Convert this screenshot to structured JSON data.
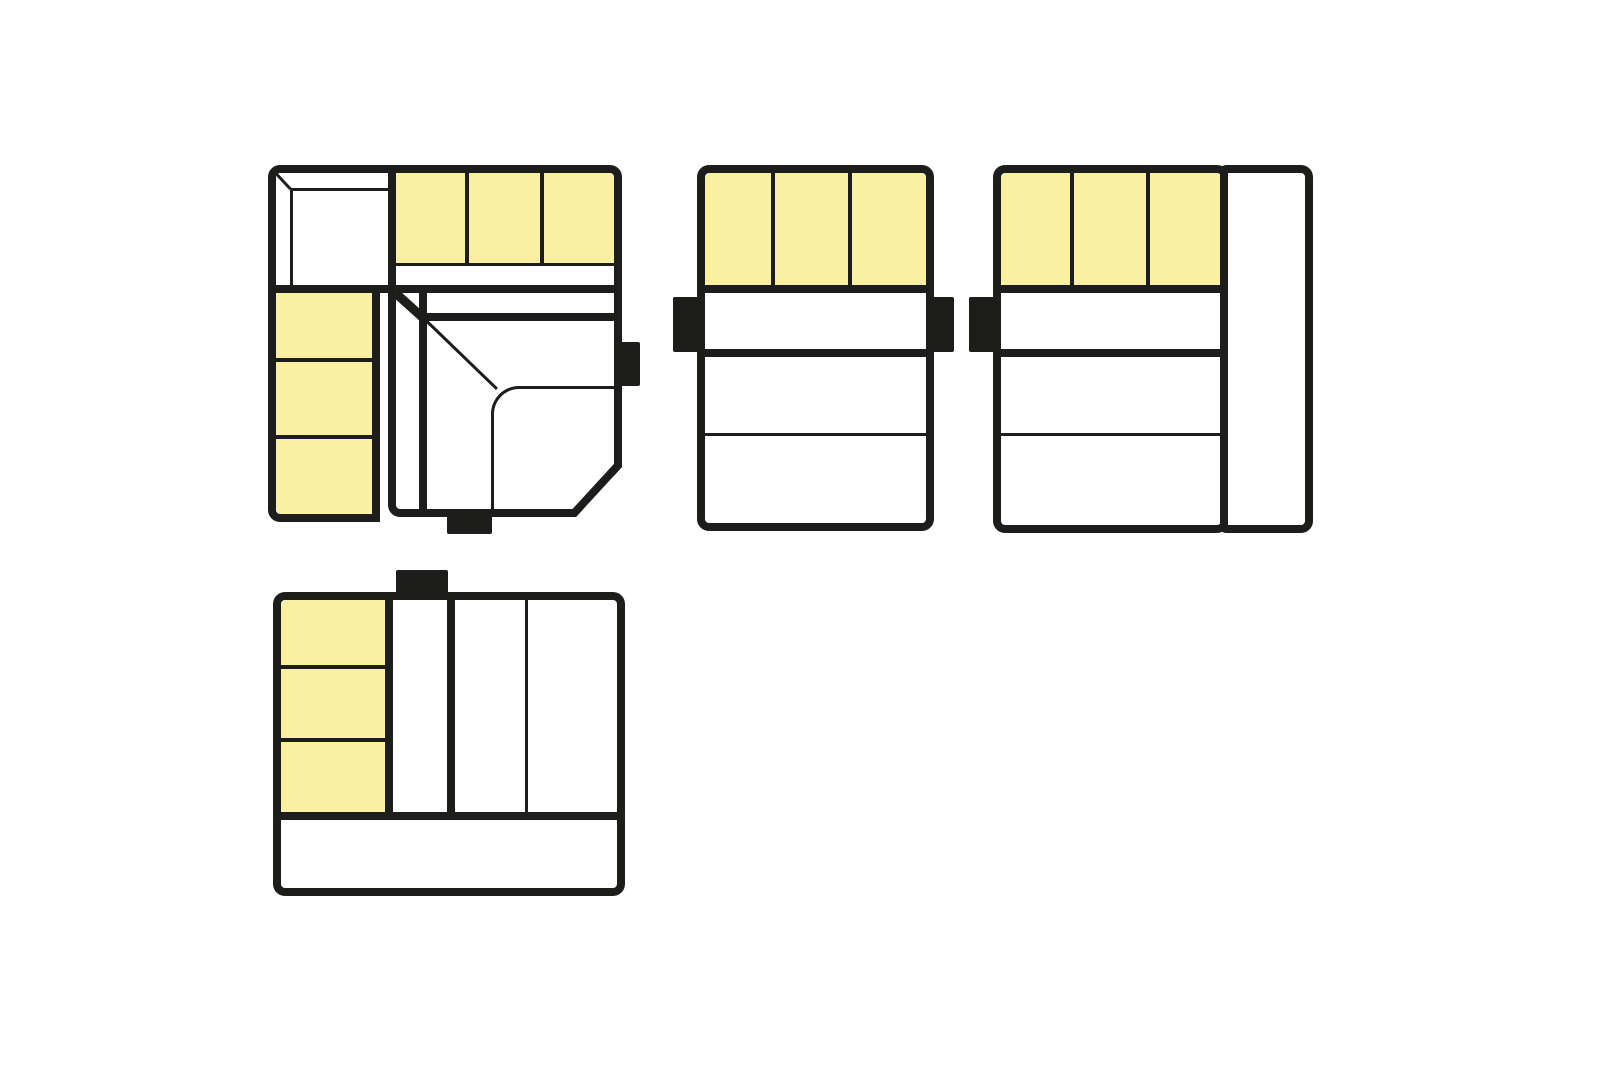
{
  "canvas": {
    "width_px": 1600,
    "height_px": 1080,
    "background": "#ffffff"
  },
  "colors": {
    "outline": "#1d1d1b",
    "highlight": "#f9f1a1",
    "surface": "#ffffff"
  },
  "diagram": {
    "kind": "modular-sofa-top-view-configurations",
    "highlight_meaning": "highlighted seat modules",
    "configurations": [
      {
        "name": "corner-sofa-configuration",
        "position": "top-left",
        "modules": [
          {
            "name": "corner-back-element",
            "highlighted": false
          },
          {
            "name": "back-cushion-row",
            "highlighted": true,
            "cushion_count": 3
          },
          {
            "name": "side-cushion-column",
            "highlighted": true,
            "cushion_count": 3
          },
          {
            "name": "corner-seat-element",
            "highlighted": false,
            "chamfered_corner": "bottom-right"
          }
        ],
        "connector_tabs": [
          "right",
          "bottom"
        ]
      },
      {
        "name": "straight-sofa-configuration",
        "position": "top-center",
        "modules": [
          {
            "name": "back-cushion-row",
            "highlighted": true,
            "cushion_count": 3
          },
          {
            "name": "seat-band",
            "highlighted": false
          },
          {
            "name": "seat-area",
            "highlighted": false,
            "section_count": 2
          }
        ],
        "connector_tabs": [
          "left",
          "right"
        ]
      },
      {
        "name": "straight-sofa-with-side-element",
        "position": "top-right",
        "modules": [
          {
            "name": "back-cushion-row",
            "highlighted": true,
            "cushion_count": 3
          },
          {
            "name": "seat-band",
            "highlighted": false
          },
          {
            "name": "seat-area",
            "highlighted": false,
            "section_count": 2
          },
          {
            "name": "side-element",
            "highlighted": false
          }
        ],
        "connector_tabs": [
          "left"
        ]
      },
      {
        "name": "rotated-sofa-with-back-band",
        "position": "bottom-left",
        "modules": [
          {
            "name": "side-cushion-column",
            "highlighted": true,
            "cushion_count": 3
          },
          {
            "name": "seat-band",
            "highlighted": false
          },
          {
            "name": "seat-area",
            "highlighted": false,
            "section_count": 2
          },
          {
            "name": "back-band",
            "highlighted": false
          }
        ],
        "connector_tabs": [
          "top"
        ]
      }
    ]
  }
}
